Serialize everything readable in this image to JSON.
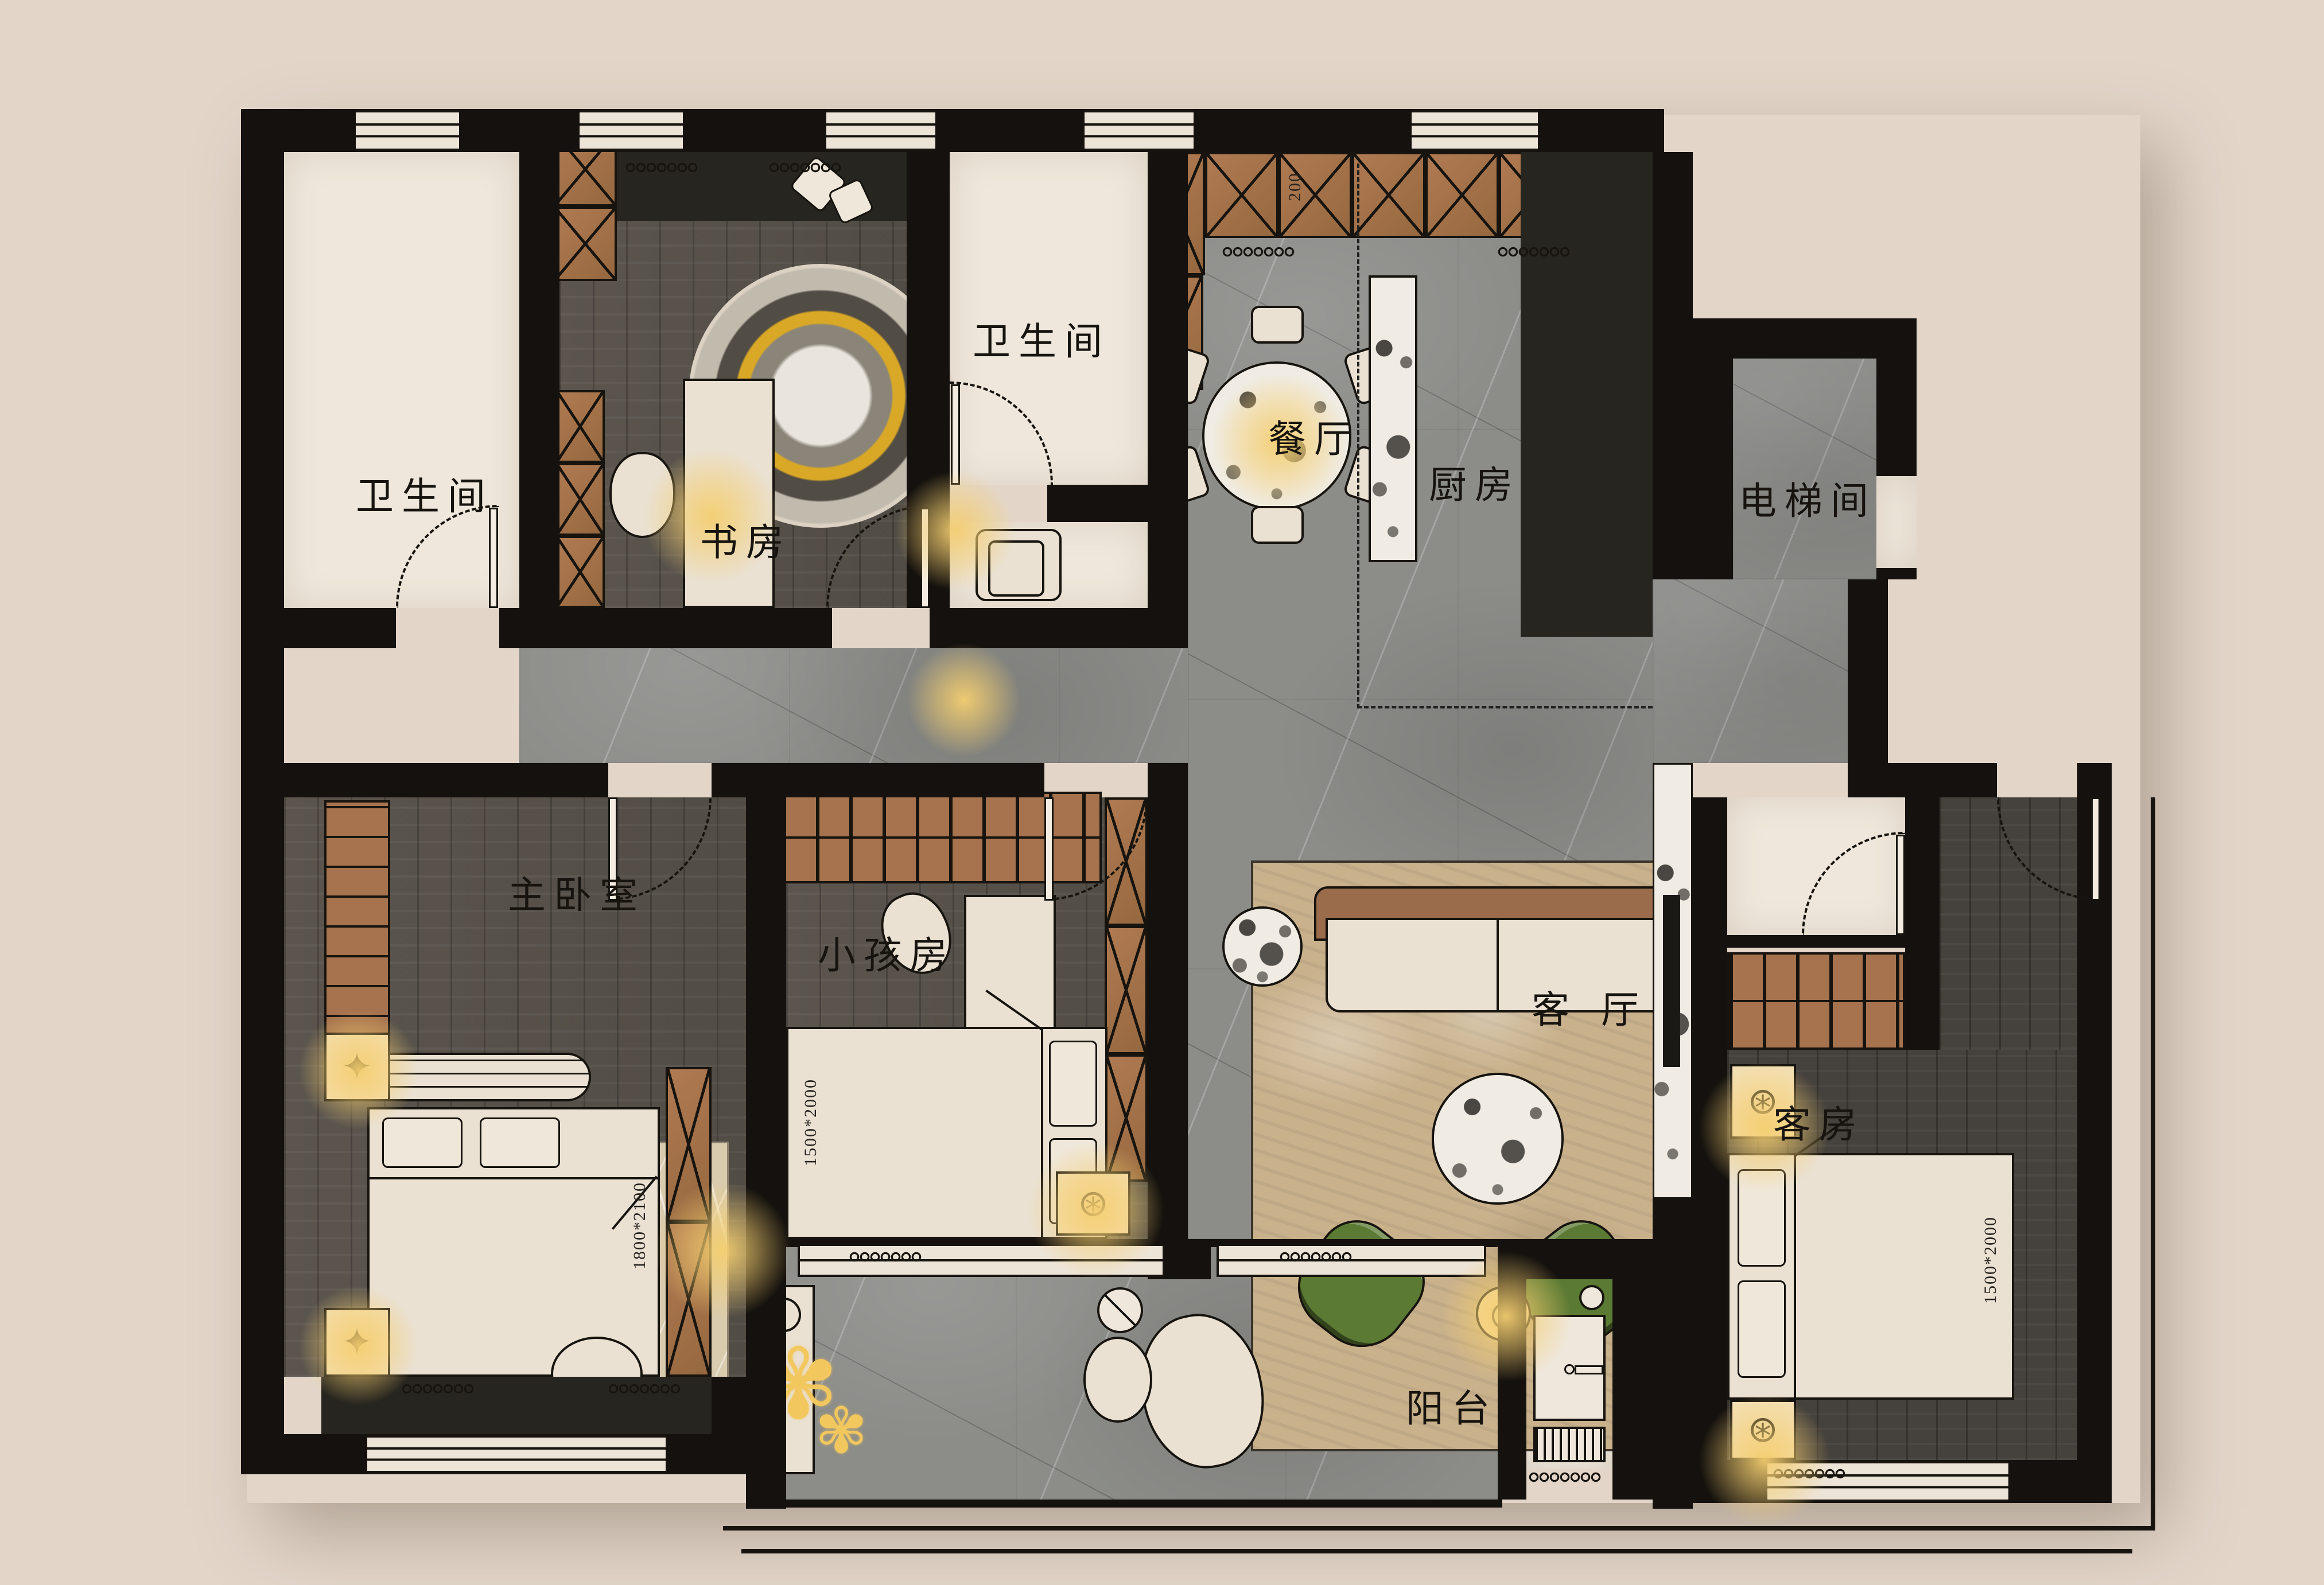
{
  "plan": {
    "background": "#E3D6C9",
    "rooms": [
      {
        "id": "bathroom-1",
        "label": "卫生间"
      },
      {
        "id": "study",
        "label": "书房"
      },
      {
        "id": "bathroom-2",
        "label": "卫生间"
      },
      {
        "id": "dining-room",
        "label": "餐厅"
      },
      {
        "id": "kitchen",
        "label": "厨房"
      },
      {
        "id": "elevator-hall",
        "label": "电梯间"
      },
      {
        "id": "master-bedroom",
        "label": "主卧室"
      },
      {
        "id": "kids-room",
        "label": "小孩房"
      },
      {
        "id": "living-room",
        "label": "客厅"
      },
      {
        "id": "guest-room",
        "label": "客房"
      },
      {
        "id": "balcony",
        "label": "阳台"
      }
    ],
    "dimensions": {
      "master_bed": "1800*2100",
      "kids_bed": "1500*2000",
      "guest_bed": "1500*2000",
      "cabinet_depth": "200"
    },
    "icons": {
      "star_lamp": "✦",
      "spoke_lamp": "⊛",
      "plant_flower": "✾"
    },
    "colors": {
      "wall": "#14110E",
      "marble_floor": "#8C8D89",
      "wood_floor": "#59534C",
      "dark_wood_floor": "#45413C",
      "white_floor": "#EFE7DB",
      "cabinet_brown": "#A6734E",
      "charcoal": "#27251F",
      "rug_living": "#C9B18C",
      "rug_master": "#D9CBAE",
      "armchair_green": "#5B7A33",
      "lamp_glow": "#F3CE79",
      "plant_yellow": "#F2C75E"
    }
  }
}
